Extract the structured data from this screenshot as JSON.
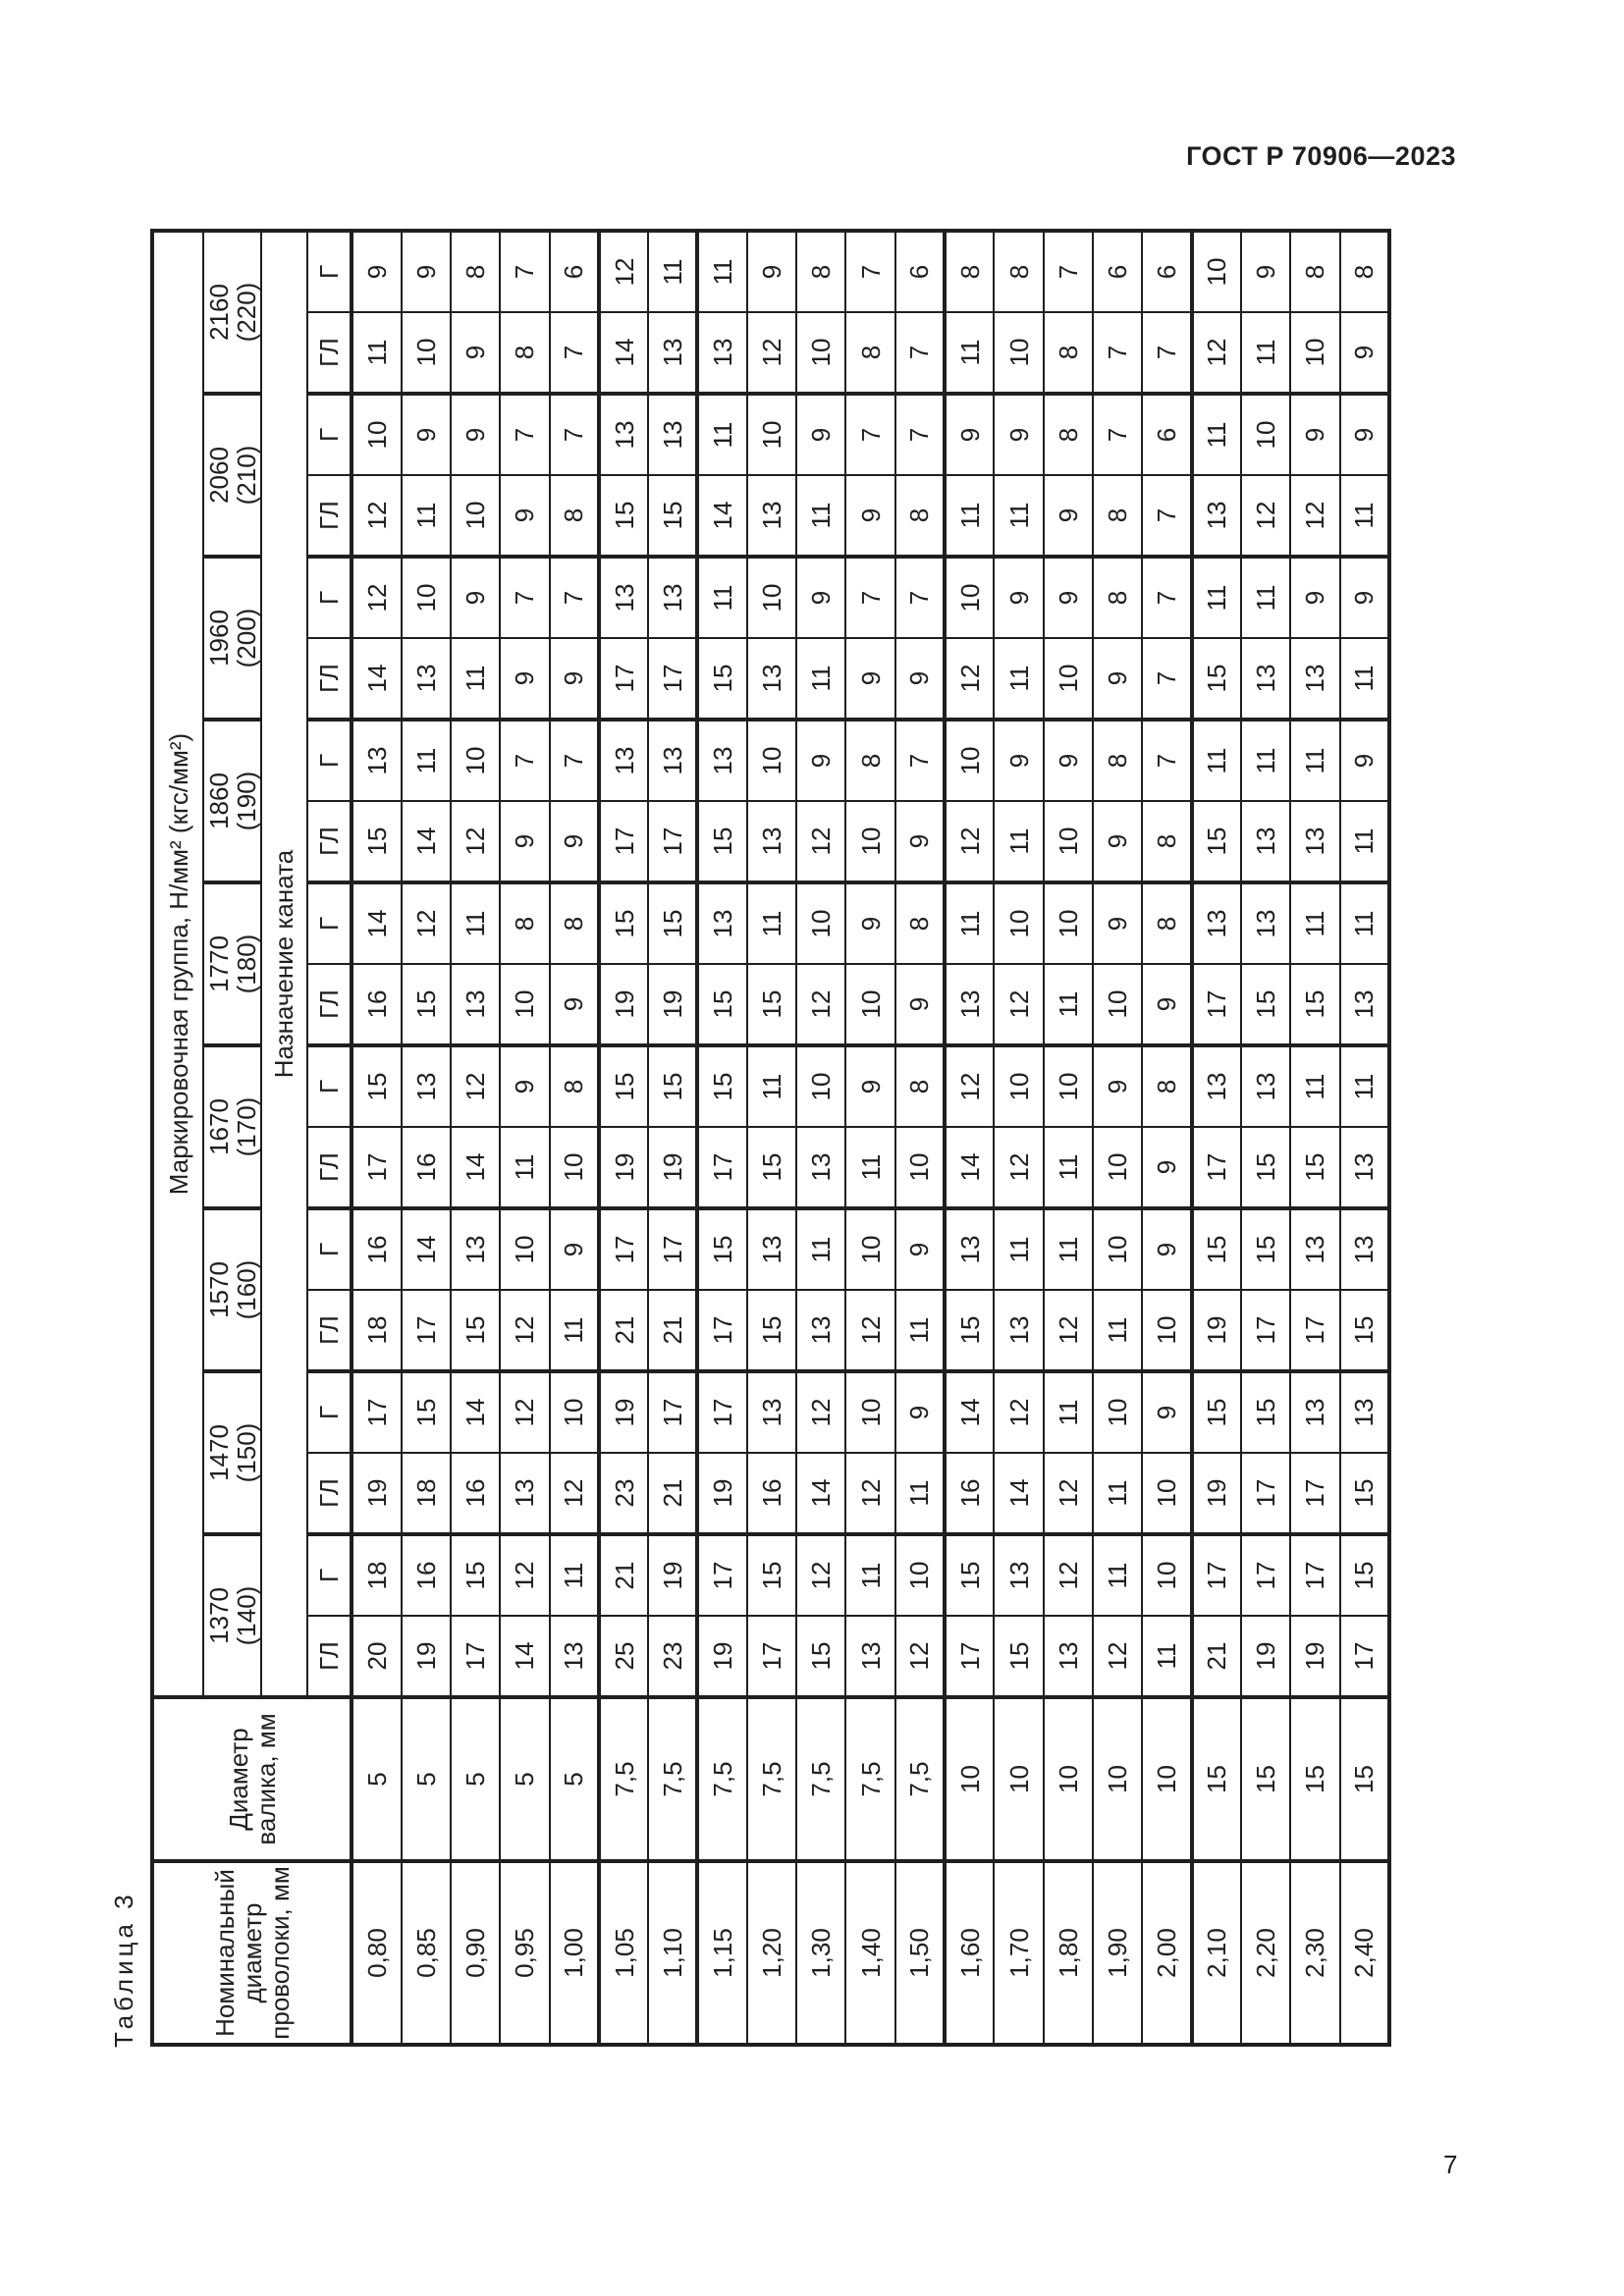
{
  "page": {
    "header": "ГОСТ Р 70906—2023",
    "page_number": "7",
    "table_caption": "Таблица 3"
  },
  "table": {
    "headers": {
      "wire": "Номинальный диаметр проволоки, мм",
      "roller": "Диаметр валика, мм",
      "marking_group": "Маркировочная группа, Н/мм² (кгс/мм²)",
      "purpose": "Назначение каната",
      "sub_gl": "ГЛ",
      "sub_g": "Г"
    },
    "rows": [
      {
        "wire": "0,80",
        "roller": "5"
      },
      {
        "wire": "0,85",
        "roller": "5"
      },
      {
        "wire": "0,90",
        "roller": "5"
      },
      {
        "wire": "0,95",
        "roller": "5"
      },
      {
        "wire": "1,00",
        "roller": "5"
      },
      {
        "wire": "1,05",
        "roller": "7,5"
      },
      {
        "wire": "1,10",
        "roller": "7,5"
      },
      {
        "wire": "1,15",
        "roller": "7,5"
      },
      {
        "wire": "1,20",
        "roller": "7,5"
      },
      {
        "wire": "1,30",
        "roller": "7,5"
      },
      {
        "wire": "1,40",
        "roller": "7,5"
      },
      {
        "wire": "1,50",
        "roller": "7,5"
      },
      {
        "wire": "1,60",
        "roller": "10"
      },
      {
        "wire": "1,70",
        "roller": "10"
      },
      {
        "wire": "1,80",
        "roller": "10"
      },
      {
        "wire": "1,90",
        "roller": "10"
      },
      {
        "wire": "2,00",
        "roller": "10"
      },
      {
        "wire": "2,10",
        "roller": "15"
      },
      {
        "wire": "2,20",
        "roller": "15"
      },
      {
        "wire": "2,30",
        "roller": "15"
      },
      {
        "wire": "2,40",
        "roller": "15"
      }
    ],
    "groups": [
      {
        "label": "1370 (140)",
        "gl": [
          20,
          19,
          17,
          14,
          13,
          25,
          23,
          19,
          17,
          15,
          13,
          12,
          17,
          15,
          13,
          12,
          11,
          21,
          19,
          19,
          17
        ],
        "g": [
          18,
          16,
          15,
          12,
          11,
          21,
          19,
          17,
          15,
          12,
          11,
          10,
          15,
          13,
          12,
          11,
          10,
          17,
          17,
          17,
          15
        ]
      },
      {
        "label": "1470 (150)",
        "gl": [
          19,
          18,
          16,
          13,
          12,
          23,
          21,
          19,
          16,
          14,
          12,
          11,
          16,
          14,
          12,
          11,
          10,
          19,
          17,
          17,
          15
        ],
        "g": [
          17,
          15,
          14,
          12,
          10,
          19,
          17,
          17,
          13,
          12,
          10,
          9,
          14,
          12,
          11,
          10,
          9,
          15,
          15,
          13,
          13
        ]
      },
      {
        "label": "1570 (160)",
        "gl": [
          18,
          17,
          15,
          12,
          11,
          21,
          21,
          17,
          15,
          13,
          12,
          11,
          15,
          13,
          12,
          11,
          10,
          19,
          17,
          17,
          15
        ],
        "g": [
          16,
          14,
          13,
          10,
          9,
          17,
          17,
          15,
          13,
          11,
          10,
          9,
          13,
          11,
          11,
          10,
          9,
          15,
          15,
          13,
          13
        ]
      },
      {
        "label": "1670 (170)",
        "gl": [
          17,
          16,
          14,
          11,
          10,
          19,
          19,
          17,
          15,
          13,
          11,
          10,
          14,
          12,
          11,
          10,
          9,
          17,
          15,
          15,
          13
        ],
        "g": [
          15,
          13,
          12,
          9,
          8,
          15,
          15,
          15,
          11,
          10,
          9,
          8,
          12,
          10,
          10,
          9,
          8,
          13,
          13,
          11,
          11
        ]
      },
      {
        "label": "1770 (180)",
        "gl": [
          16,
          15,
          13,
          10,
          9,
          19,
          19,
          15,
          15,
          12,
          10,
          9,
          13,
          12,
          11,
          10,
          9,
          17,
          15,
          15,
          13
        ],
        "g": [
          14,
          12,
          11,
          8,
          8,
          15,
          15,
          13,
          11,
          10,
          9,
          8,
          11,
          10,
          10,
          9,
          8,
          13,
          13,
          11,
          11
        ]
      },
      {
        "label": "1860 (190)",
        "gl": [
          15,
          14,
          12,
          9,
          9,
          17,
          17,
          15,
          13,
          12,
          10,
          9,
          12,
          11,
          10,
          9,
          8,
          15,
          13,
          13,
          11
        ],
        "g": [
          13,
          11,
          10,
          7,
          7,
          13,
          13,
          13,
          10,
          9,
          8,
          7,
          10,
          9,
          9,
          8,
          7,
          11,
          11,
          11,
          9
        ]
      },
      {
        "label": "1960 (200)",
        "gl": [
          14,
          13,
          11,
          9,
          9,
          17,
          17,
          15,
          13,
          11,
          9,
          9,
          12,
          11,
          10,
          9,
          7,
          15,
          13,
          13,
          11
        ],
        "g": [
          12,
          10,
          9,
          7,
          7,
          13,
          13,
          11,
          10,
          9,
          7,
          7,
          10,
          9,
          9,
          8,
          7,
          11,
          11,
          9,
          9
        ]
      },
      {
        "label": "2060 (210)",
        "gl": [
          12,
          11,
          10,
          9,
          8,
          15,
          15,
          14,
          13,
          11,
          9,
          8,
          11,
          11,
          9,
          8,
          7,
          13,
          12,
          12,
          11
        ],
        "g": [
          10,
          9,
          9,
          7,
          7,
          13,
          13,
          11,
          10,
          9,
          7,
          7,
          9,
          9,
          8,
          7,
          6,
          11,
          10,
          9,
          9
        ]
      },
      {
        "label": "2160 (220)",
        "gl": [
          11,
          10,
          9,
          8,
          7,
          14,
          13,
          13,
          12,
          10,
          8,
          7,
          11,
          10,
          8,
          7,
          7,
          12,
          11,
          10,
          9
        ],
        "g": [
          9,
          9,
          8,
          7,
          6,
          12,
          11,
          11,
          9,
          8,
          7,
          6,
          8,
          8,
          7,
          6,
          6,
          10,
          9,
          8,
          8
        ]
      }
    ]
  }
}
